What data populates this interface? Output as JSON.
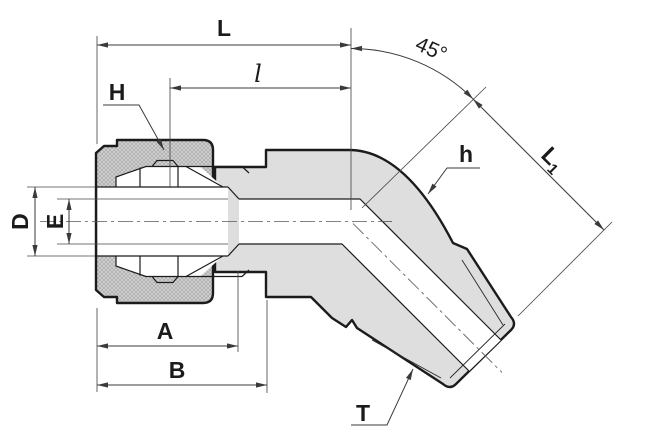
{
  "drawing": {
    "labels": {
      "L": "L",
      "l": "l",
      "angle": "45°",
      "H": "H",
      "h": "h",
      "L1_base": "L",
      "L1_sub": "1",
      "D": "D",
      "E": "E",
      "A": "A",
      "B": "B",
      "T": "T"
    },
    "colors": {
      "background": "#ffffff",
      "part_outline": "#1b1b1b",
      "dimension_lines": "#3a3a3a",
      "body_fill": "#dedede",
      "nut_fill": "#d2d2d2",
      "hatch_line": "#a0a0a0"
    }
  }
}
